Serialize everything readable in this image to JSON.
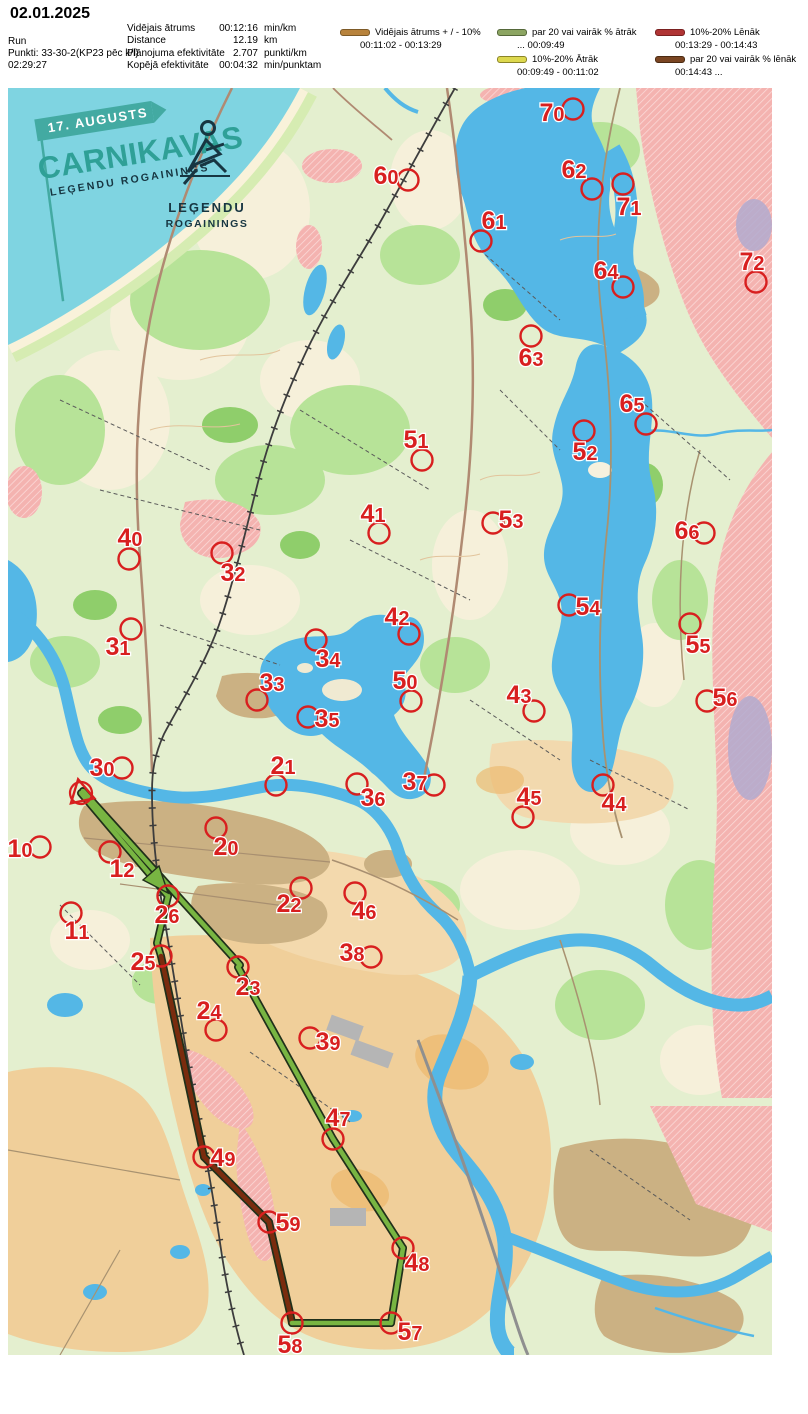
{
  "header": {
    "date": "02.01.2025",
    "run_label": "Run",
    "points_label": "Punkti: 33-30-2(KP23 pēc k/l)",
    "total_time": "02:29:27",
    "stats": [
      {
        "label": "Vidējais ātrums",
        "value": "00:12:16",
        "unit": "min/km"
      },
      {
        "label": "Distance",
        "value": "12.19",
        "unit": "km"
      },
      {
        "label": "Plānojuma efektivitāte",
        "value": "2.707",
        "unit": "punkti/km"
      },
      {
        "label": "Kopējā efektivitāte",
        "value": "00:04:32",
        "unit": "min/punktam"
      }
    ]
  },
  "legend": [
    {
      "label": "Vidējais ātrums + / - 10%",
      "times": "00:11:02   -   00:13:29",
      "color": "#b8833c",
      "border": "#7d5a27"
    },
    {
      "label": "par 20 vai vairāk % ātrāk",
      "times": "...    00:09:49",
      "color": "#8ca562",
      "border": "#55683a"
    },
    {
      "label": "10%-20% Lēnāk",
      "times": "00:13:29   - 00:14:43",
      "color": "#b03434",
      "border": "#7a2020"
    },
    {
      "label": "10%-20% Ātrāk",
      "times": "00:09:49   -   00:11:02",
      "color": "#ddd84e",
      "border": "#8a8428"
    },
    {
      "label": "par 20 vai vairāk % lēnāk",
      "times": "00:14:43   ...",
      "color": "#7a4522",
      "border": "#4a2a12"
    }
  ],
  "map": {
    "event": {
      "flag": "17. AUGUSTS",
      "title": "CARNIKAVAS",
      "subtitle": "LEĢENDU ROGAININGS",
      "logo_line1": "LEĢENDU",
      "logo_line2": "ROGAININGS"
    },
    "colors": {
      "control": "#d81f1f",
      "fast": "#78b542",
      "slowest": "#7a2c0e",
      "casing": "#20301a"
    },
    "start": {
      "x": 81,
      "y": 793
    },
    "arrow": {
      "points": "168,893 143,880 159,866"
    },
    "route": [
      {
        "speed": "fast",
        "pts": "81,793 168,896"
      },
      {
        "speed": "fast",
        "pts": "168,896 157,943 161,956"
      },
      {
        "speed": "slowest",
        "pts": "161,956 204,1157"
      },
      {
        "speed": "slowest",
        "pts": "204,1157 269,1222"
      },
      {
        "speed": "slowest",
        "pts": "269,1222 290,1313 292,1323"
      },
      {
        "speed": "fast",
        "pts": "292,1323 391,1323"
      },
      {
        "speed": "fast",
        "pts": "391,1323 403,1248"
      },
      {
        "speed": "fast",
        "pts": "403,1248 333,1139"
      },
      {
        "speed": "fast",
        "pts": "333,1139 238,967"
      },
      {
        "speed": "fast",
        "pts": "240,965 83,791"
      }
    ],
    "controls": [
      {
        "n": "10",
        "x": 40,
        "y": 847,
        "lx": 20,
        "ly": 849
      },
      {
        "n": "11",
        "x": 71,
        "y": 913,
        "lx": 77,
        "ly": 931
      },
      {
        "n": "12",
        "x": 110,
        "y": 852,
        "lx": 122,
        "ly": 869
      },
      {
        "n": "20",
        "x": 216,
        "y": 828,
        "lx": 226,
        "ly": 847
      },
      {
        "n": "21",
        "x": 276,
        "y": 785,
        "lx": 283,
        "ly": 766
      },
      {
        "n": "22",
        "x": 301,
        "y": 888,
        "lx": 289,
        "ly": 904
      },
      {
        "n": "23",
        "x": 238,
        "y": 967,
        "lx": 248,
        "ly": 987
      },
      {
        "n": "24",
        "x": 216,
        "y": 1030,
        "lx": 209,
        "ly": 1011
      },
      {
        "n": "25",
        "x": 161,
        "y": 956,
        "lx": 143,
        "ly": 962
      },
      {
        "n": "26",
        "x": 168,
        "y": 896,
        "lx": 167,
        "ly": 915
      },
      {
        "n": "30",
        "x": 122,
        "y": 768,
        "lx": 102,
        "ly": 768
      },
      {
        "n": "31",
        "x": 131,
        "y": 629,
        "lx": 118,
        "ly": 647
      },
      {
        "n": "32",
        "x": 222,
        "y": 553,
        "lx": 233,
        "ly": 573
      },
      {
        "n": "33",
        "x": 257,
        "y": 700,
        "lx": 272,
        "ly": 683
      },
      {
        "n": "34",
        "x": 316,
        "y": 640,
        "lx": 328,
        "ly": 659
      },
      {
        "n": "35",
        "x": 308,
        "y": 717,
        "lx": 327,
        "ly": 719
      },
      {
        "n": "36",
        "x": 357,
        "y": 784,
        "lx": 373,
        "ly": 798
      },
      {
        "n": "37",
        "x": 434,
        "y": 785,
        "lx": 415,
        "ly": 782
      },
      {
        "n": "38",
        "x": 371,
        "y": 957,
        "lx": 352,
        "ly": 953
      },
      {
        "n": "39",
        "x": 310,
        "y": 1038,
        "lx": 328,
        "ly": 1042
      },
      {
        "n": "40",
        "x": 129,
        "y": 559,
        "lx": 130,
        "ly": 538
      },
      {
        "n": "41",
        "x": 379,
        "y": 533,
        "lx": 373,
        "ly": 514
      },
      {
        "n": "42",
        "x": 409,
        "y": 634,
        "lx": 397,
        "ly": 617
      },
      {
        "n": "43",
        "x": 534,
        "y": 711,
        "lx": 519,
        "ly": 695
      },
      {
        "n": "44",
        "x": 603,
        "y": 785,
        "lx": 614,
        "ly": 803
      },
      {
        "n": "45",
        "x": 523,
        "y": 817,
        "lx": 529,
        "ly": 797
      },
      {
        "n": "46",
        "x": 355,
        "y": 893,
        "lx": 364,
        "ly": 911
      },
      {
        "n": "47",
        "x": 333,
        "y": 1139,
        "lx": 338,
        "ly": 1118
      },
      {
        "n": "48",
        "x": 403,
        "y": 1248,
        "lx": 417,
        "ly": 1263
      },
      {
        "n": "49",
        "x": 204,
        "y": 1157,
        "lx": 223,
        "ly": 1158
      },
      {
        "n": "50",
        "x": 411,
        "y": 701,
        "lx": 405,
        "ly": 681
      },
      {
        "n": "51",
        "x": 422,
        "y": 460,
        "lx": 416,
        "ly": 440
      },
      {
        "n": "52",
        "x": 584,
        "y": 431,
        "lx": 585,
        "ly": 452
      },
      {
        "n": "53",
        "x": 493,
        "y": 523,
        "lx": 511,
        "ly": 520
      },
      {
        "n": "54",
        "x": 569,
        "y": 605,
        "lx": 588,
        "ly": 607
      },
      {
        "n": "55",
        "x": 690,
        "y": 624,
        "lx": 698,
        "ly": 645
      },
      {
        "n": "56",
        "x": 707,
        "y": 701,
        "lx": 725,
        "ly": 698
      },
      {
        "n": "57",
        "x": 391,
        "y": 1323,
        "lx": 410,
        "ly": 1332
      },
      {
        "n": "58",
        "x": 292,
        "y": 1323,
        "lx": 290,
        "ly": 1345
      },
      {
        "n": "59",
        "x": 269,
        "y": 1222,
        "lx": 288,
        "ly": 1223
      },
      {
        "n": "60",
        "x": 408,
        "y": 180,
        "lx": 386,
        "ly": 176
      },
      {
        "n": "61",
        "x": 481,
        "y": 241,
        "lx": 494,
        "ly": 221
      },
      {
        "n": "62",
        "x": 592,
        "y": 189,
        "lx": 574,
        "ly": 170
      },
      {
        "n": "63",
        "x": 531,
        "y": 336,
        "lx": 531,
        "ly": 358
      },
      {
        "n": "64",
        "x": 623,
        "y": 287,
        "lx": 606,
        "ly": 271
      },
      {
        "n": "65",
        "x": 646,
        "y": 424,
        "lx": 632,
        "ly": 404
      },
      {
        "n": "66",
        "x": 704,
        "y": 533,
        "lx": 687,
        "ly": 531
      },
      {
        "n": "70",
        "x": 573,
        "y": 109,
        "lx": 552,
        "ly": 113
      },
      {
        "n": "71",
        "x": 623,
        "y": 184,
        "lx": 629,
        "ly": 207
      },
      {
        "n": "72",
        "x": 756,
        "y": 282,
        "lx": 752,
        "ly": 262
      }
    ]
  }
}
